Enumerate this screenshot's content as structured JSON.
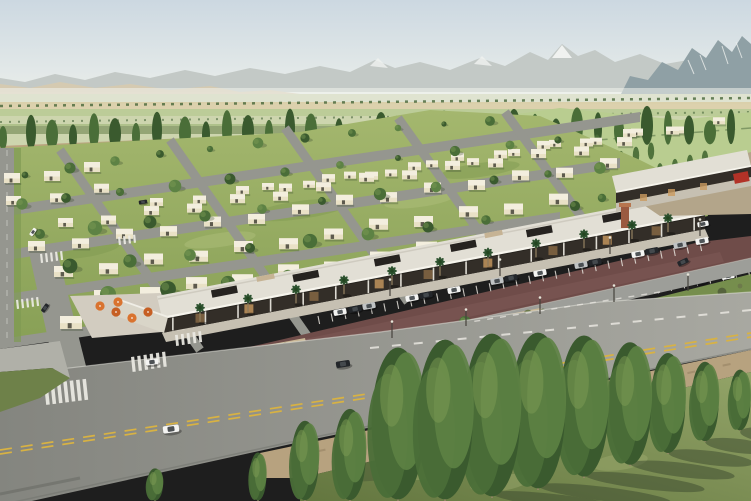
{
  "scene": {
    "type": "aerial-architectural-rendering",
    "palette": {
      "sky_top": "#ccd8e1",
      "sky_mid": "#dfe6e7",
      "sky_horizon": "#eef0ea",
      "mtn_far": "#c3c9c6",
      "mtn_snow": "#f0f2f0",
      "mtn_right": "#8fa0a5",
      "hills_tan": "#d6cab0",
      "field_far": "#dfe3d0",
      "field_tan": "#d9cda6",
      "field_green": "#bccc98",
      "field_base": "#cdd5ae",
      "field_dark": "#a9bd85",
      "hedge_green": "#47663a",
      "lawn_dark": "#7f9a52",
      "lawn_light": "#adbe7a",
      "street": "#95968f",
      "tree1": "#3a5a2e",
      "tree2": "#4a6e38",
      "tree3": "#5d8244",
      "tree_hi": "#7d9c54",
      "house_wall": "#e9e1c6",
      "house_roof": "#f3eede",
      "house_win": "#3a382e",
      "mall_dark": "#332e28",
      "mall_roof": "#e2dfd5",
      "mall_col": "#ece9e1",
      "mall_box": "#262320",
      "plaza": "#d2ccc0",
      "palm": "#2e5330",
      "palm_trunk": "#8d7c5d",
      "umbrella": "#d9732f",
      "umbrella2": "#c65f24",
      "lot": "#6f4c49",
      "lot_light": "#7d5955",
      "stall": "#e7e3dc",
      "drive": "#9d9e99",
      "gravel": "#c9b795",
      "shrub": "#6d7a4b",
      "shrub_dark": "#55633c",
      "yellow": "#d8b243",
      "white_line": "#eceae4",
      "dirt": "#b7a27f",
      "grass_dark": "#566743",
      "shadow": "#39482d",
      "car_white": "#f4f4f2",
      "car_black": "#23262a",
      "car_silver": "#c0c3c4",
      "pole": "#46423c",
      "sign_red": "#b23227"
    },
    "back_poplars": {
      "count": 34,
      "x0": 6,
      "spacing": 22,
      "base_y0": 150,
      "base_slope": -0.008,
      "h_min": 24
    },
    "field_poplar_rows": [
      [
        470,
        162
      ],
      [
        522,
        172
      ],
      [
        576,
        180
      ],
      [
        630,
        188
      ]
    ],
    "row_slope": -0.15,
    "house_rows": [
      {
        "x": 4,
        "y": 176,
        "n": 3,
        "dx": 40,
        "w": 16,
        "h": 10
      },
      {
        "x": 6,
        "y": 199,
        "n": 3,
        "dx": 44,
        "w": 15,
        "h": 9
      },
      {
        "x": 262,
        "y": 186,
        "n": 12,
        "dx": 41,
        "w": 12,
        "h": 7
      },
      {
        "x": 150,
        "y": 201,
        "n": 13,
        "dx": 43,
        "w": 13,
        "h": 8
      },
      {
        "x": 58,
        "y": 221,
        "n": 14,
        "dx": 43,
        "w": 15,
        "h": 9
      },
      {
        "x": 28,
        "y": 244,
        "n": 14,
        "dx": 44,
        "w": 17,
        "h": 10
      },
      {
        "x": 54,
        "y": 269,
        "n": 12,
        "dx": 45,
        "w": 19,
        "h": 11
      },
      {
        "x": 94,
        "y": 293,
        "n": 10,
        "dx": 46,
        "w": 21,
        "h": 12
      },
      {
        "x": 60,
        "y": 319,
        "n": 4,
        "dx": 46,
        "w": 22,
        "h": 13
      }
    ],
    "scatter_trees": [
      [
        25,
        175
      ],
      [
        70,
        168
      ],
      [
        115,
        161
      ],
      [
        160,
        154
      ],
      [
        210,
        149
      ],
      [
        258,
        143
      ],
      [
        305,
        138
      ],
      [
        352,
        133
      ],
      [
        398,
        128
      ],
      [
        444,
        124
      ],
      [
        490,
        121
      ],
      [
        22,
        204
      ],
      [
        66,
        198
      ],
      [
        120,
        192
      ],
      [
        175,
        186
      ],
      [
        230,
        179
      ],
      [
        285,
        172
      ],
      [
        340,
        165
      ],
      [
        398,
        158
      ],
      [
        455,
        151
      ],
      [
        510,
        145
      ],
      [
        558,
        140
      ],
      [
        40,
        234
      ],
      [
        95,
        228
      ],
      [
        150,
        222
      ],
      [
        205,
        216
      ],
      [
        262,
        209
      ],
      [
        322,
        201
      ],
      [
        380,
        194
      ],
      [
        436,
        187
      ],
      [
        494,
        180
      ],
      [
        548,
        174
      ],
      [
        600,
        168
      ],
      [
        70,
        266
      ],
      [
        130,
        261
      ],
      [
        190,
        255
      ],
      [
        250,
        248
      ],
      [
        310,
        241
      ],
      [
        368,
        234
      ],
      [
        428,
        227
      ],
      [
        486,
        220
      ],
      [
        108,
        294
      ],
      [
        168,
        289
      ],
      [
        228,
        283
      ],
      [
        288,
        276
      ],
      [
        346,
        270
      ],
      [
        148,
        318
      ],
      [
        206,
        312
      ],
      [
        575,
        206
      ],
      [
        602,
        198
      ],
      [
        640,
        190
      ]
    ],
    "mall": {
      "front": [
        162,
        318,
        705,
        214
      ],
      "store_h": 15,
      "roof_units_t": [
        0.12,
        0.27,
        0.42,
        0.56,
        0.7,
        0.84
      ],
      "tan_units_t": [
        0.2,
        0.62
      ],
      "glow_t": [
        0.07,
        0.16,
        0.28,
        0.4,
        0.49,
        0.6,
        0.72,
        0.82,
        0.91
      ],
      "column_count": 17,
      "palm_x": [
        200,
        248,
        296,
        344,
        392,
        440,
        488,
        536,
        584,
        632,
        668
      ]
    },
    "umbrellas": [
      [
        100,
        306
      ],
      [
        116,
        312
      ],
      [
        132,
        318
      ],
      [
        148,
        312
      ],
      [
        118,
        302
      ]
    ],
    "parking": {
      "stripe_rows": [
        [
          318,
          316,
          700,
          243
        ],
        [
          345,
          345,
          748,
          268
        ]
      ],
      "stripe_step": 13,
      "cars": [
        [
          340,
          312,
          "w"
        ],
        [
          355,
          309,
          "k"
        ],
        [
          369,
          306,
          "s"
        ],
        [
          412,
          298,
          "w"
        ],
        [
          426,
          295,
          "k"
        ],
        [
          454,
          290,
          "w"
        ],
        [
          497,
          281,
          "s"
        ],
        [
          511,
          278,
          "k"
        ],
        [
          540,
          273,
          "w"
        ],
        [
          581,
          265,
          "s"
        ],
        [
          595,
          262,
          "k"
        ],
        [
          638,
          254,
          "w"
        ],
        [
          652,
          251,
          "k"
        ],
        [
          680,
          245,
          "s"
        ],
        [
          702,
          241,
          "w"
        ],
        [
          374,
          343,
          "k"
        ],
        [
          432,
          332,
          "w"
        ],
        [
          474,
          324,
          "s"
        ],
        [
          532,
          313,
          "w"
        ],
        [
          574,
          305,
          "k"
        ],
        [
          616,
          297,
          "s"
        ],
        [
          700,
          281,
          "k"
        ],
        [
          728,
          276,
          "w"
        ]
      ]
    },
    "road_cars": [
      [
        152,
        362,
        "w",
        0.9,
        -8
      ],
      [
        171,
        429,
        "w",
        1.15,
        -8
      ],
      [
        343,
        364,
        "k",
        1,
        -9
      ],
      [
        683,
        262,
        "k",
        0.8,
        -25
      ],
      [
        703,
        224,
        "w",
        0.8,
        -11
      ],
      [
        33,
        232,
        "w",
        0.6,
        -55
      ],
      [
        45,
        308,
        "k",
        0.65,
        -55
      ],
      [
        143,
        202,
        "k",
        0.6,
        -9
      ]
    ],
    "crosswalks": [
      {
        "x": 44,
        "y": 384,
        "n": 7,
        "dx": 6.4,
        "dy": -0.8,
        "w": 3.6,
        "h": 21
      },
      {
        "x": 131,
        "y": 357,
        "n": 6,
        "dx": 6.2,
        "dy": -1.0,
        "w": 3.2,
        "h": 15
      },
      {
        "x": 175,
        "y": 335,
        "n": 5,
        "dx": 5.8,
        "dy": -0.9,
        "w": 2.8,
        "h": 11
      },
      {
        "x": 40,
        "y": 254,
        "n": 5,
        "dx": 5.0,
        "dy": -0.7,
        "w": 2.2,
        "h": 9
      },
      {
        "x": 16,
        "y": 300,
        "n": 5,
        "dx": 5.0,
        "dy": -0.7,
        "w": 2.2,
        "h": 9
      },
      {
        "x": 118,
        "y": 237,
        "n": 4,
        "dx": 5.0,
        "dy": -0.7,
        "w": 2.2,
        "h": 8
      }
    ],
    "shrubs": [
      [
        105,
        398
      ],
      [
        125,
        392
      ],
      [
        145,
        386
      ],
      [
        165,
        380
      ],
      [
        185,
        373
      ],
      [
        205,
        366
      ],
      [
        225,
        360
      ],
      [
        245,
        355
      ],
      [
        265,
        350
      ],
      [
        285,
        345
      ],
      [
        120,
        401
      ],
      [
        160,
        391
      ],
      [
        200,
        373
      ],
      [
        240,
        363
      ],
      [
        280,
        351
      ],
      [
        298,
        344
      ],
      [
        448,
        330
      ],
      [
        468,
        326
      ],
      [
        488,
        322
      ],
      [
        508,
        318
      ],
      [
        528,
        314
      ],
      [
        543,
        311
      ],
      [
        700,
        300
      ],
      [
        722,
        292
      ],
      [
        740,
        286
      ],
      [
        672,
        310
      ],
      [
        650,
        316
      ]
    ],
    "island_trees": [
      [
        150,
        384
      ],
      [
        240,
        358
      ],
      [
        465,
        322
      ]
    ],
    "fg_trees": [
      [
        155,
        468,
        501
      ],
      [
        258,
        452,
        501
      ],
      [
        305,
        420,
        501
      ],
      [
        350,
        408,
        501
      ],
      [
        398,
        346,
        501
      ],
      [
        445,
        338,
        501
      ],
      [
        492,
        332,
        498
      ],
      [
        538,
        331,
        490
      ],
      [
        584,
        334,
        478
      ],
      [
        630,
        341,
        466
      ],
      [
        668,
        352,
        454
      ],
      [
        705,
        361,
        442
      ],
      [
        740,
        369,
        431
      ]
    ],
    "light_poles": [
      [
        392,
        338
      ],
      [
        466,
        326
      ],
      [
        540,
        314
      ],
      [
        614,
        302
      ],
      [
        688,
        291
      ],
      [
        390,
        296
      ],
      [
        500,
        276
      ],
      [
        610,
        254
      ],
      [
        700,
        236
      ]
    ]
  }
}
